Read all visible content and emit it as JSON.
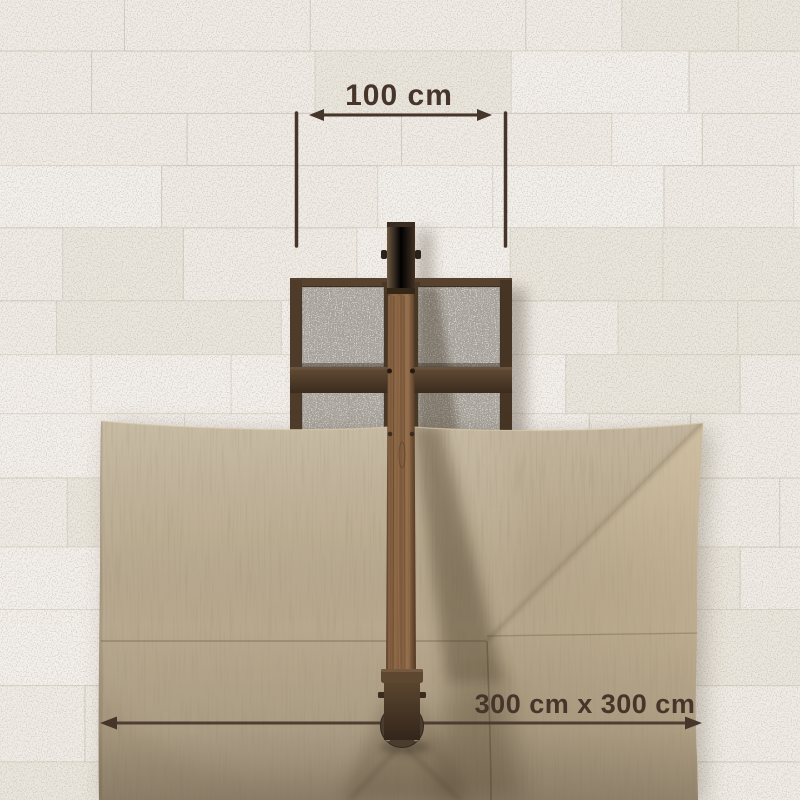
{
  "annotations": {
    "base_width": {
      "label": "100 cm",
      "value_cm": 100
    },
    "canopy_size": {
      "label": "300 cm x 300 cm",
      "width_cm": 300,
      "depth_cm": 300
    }
  },
  "colors": {
    "annotation": "#46352a",
    "tile_base": "#f0ece5",
    "grout": "#d3ccc0",
    "canopy": "#b2a287",
    "slab": "#a9a59e",
    "metal_frame": "#4a3827",
    "wood": "#7d5a3c"
  }
}
